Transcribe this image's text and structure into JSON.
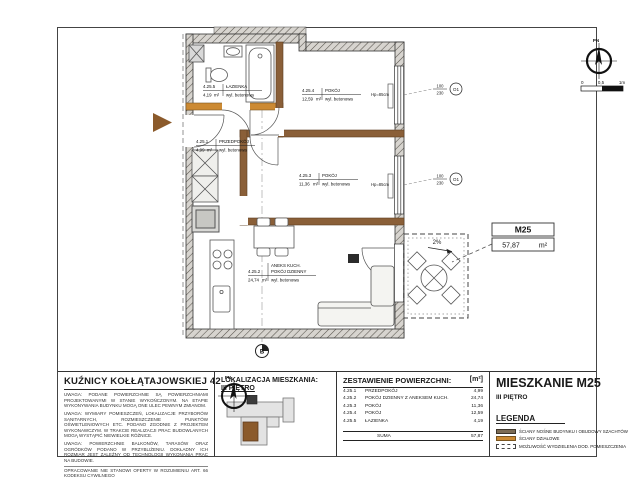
{
  "plan": {
    "area_unit": "m²",
    "floor_finish": "wyl. betonowa",
    "rooms": {
      "bathroom": {
        "no": "4.25.5",
        "name": "ŁAZIENKA",
        "area": "4,19"
      },
      "hall": {
        "no": "4.25.1",
        "name": "PRZEDPOKÓJ",
        "area": "4,99"
      },
      "room_top": {
        "no": "4.25.4",
        "name": "POKÓJ",
        "area": "12,59"
      },
      "room_mid": {
        "no": "4.25.3",
        "name": "POKÓJ",
        "area": "11,36"
      },
      "living": {
        "no": "4.25.2",
        "name1": "ANEKS KUCH.",
        "name2": "POKÓJ DZIENNY",
        "area": "24,74"
      }
    },
    "window": {
      "sill": "Hp=85cm",
      "dim_top": "100",
      "dim_bottom": "230",
      "mark": "O1"
    },
    "slope": "2%",
    "section_mark": "B"
  },
  "unit_box": {
    "id": "M25",
    "area": "57,87",
    "unit": "m²"
  },
  "compass": {
    "label": "PN"
  },
  "scalebar": {
    "t0": "0",
    "t05": "0,5",
    "t1": "1m"
  },
  "titleblock": {
    "address": {
      "title": "KUŹNICY KOŁŁĄTAJOWSKIEJ 42",
      "notes": [
        "UWAGA: PODANE POWIERZCHNIE SĄ POWIERZCHNIAMI PROJEKTOWANYMI W STANIE WYKOŃCZONYM. NA ETAPIE WYKONYWANIA BUDYNKU MOGĄ ONE ULEC PEWNYM ZMIANOM.",
        "UWAGA: WYMIARY POMIESZCZEŃ, LOKALIZACJE PRZYBORÓW SANITARNYCH, ROZMIESZCZENIE PUNKTÓW OŚWIETLENIOWYCH ETC. PODANO ZGODNIE Z PROJEKTEM WYKONAWCZYM. W TRAKCIE REALIZACJI PRAC BUDOWLANYCH MOGĄ WYSTĄPIĆ NIEWIELKIE RÓŻNICE.",
        "UWAGA: POWIERZCHNIE BALKONÓW, TARASÓW ORAZ OGRÓDKÓW PODANO W PRZYBLIŻENIU. DOKŁADNY ICH ROZMIAR JEST ZALEŻNY OD TECHNOLOGII WYKONANIA PRAC NA BUDOWIE.",
        "OPRACOWANIE NIE STANOWI OFERTY W ROZUMIENIU ART. 66 KODEKSU CYWILNEGO"
      ]
    },
    "location": {
      "title": "LOKALIZACJA MIESZKANIA:",
      "floor": "III PIĘTRO",
      "compass_label": "PN"
    },
    "areas": {
      "title": "ZESTAWIENIE POWIERZCHNI:",
      "unit": "[m²]",
      "rows": [
        {
          "no": "4.25.1",
          "name": "PRZEDPOKÓJ",
          "value": "4,99"
        },
        {
          "no": "4.25.2",
          "name": "POKÓJ DZIENNY Z ANEKSEM KUCH.",
          "value": "24,74"
        },
        {
          "no": "4.25.3",
          "name": "POKÓJ",
          "value": "11,36"
        },
        {
          "no": "4.25.4",
          "name": "POKÓJ",
          "value": "12,59"
        },
        {
          "no": "4.25.5",
          "name": "ŁAZIENKA",
          "value": "4,19"
        }
      ],
      "sum_label": "SUMA",
      "sum": "57,87"
    },
    "unit": {
      "title": "MIESZKANIE M25",
      "floor": "III PIĘTRO",
      "legend_title": "LEGENDA",
      "legend": [
        {
          "label": "ŚCIANY NOŚNE BUDYNKU I OBUDOWY SZACHTÓW"
        },
        {
          "label": "ŚCIANY DZIAŁOWE"
        },
        {
          "label": "MOŻLIWOŚĆ WYDZIELENIA DOD. POMIESZCZENIA"
        }
      ]
    }
  },
  "colors": {
    "wall_bearing": "#7c6b54",
    "wall_partition": "#cc8a33",
    "wall_interior": "#8a5f38",
    "unit_highlight": "#8b5a2b"
  }
}
